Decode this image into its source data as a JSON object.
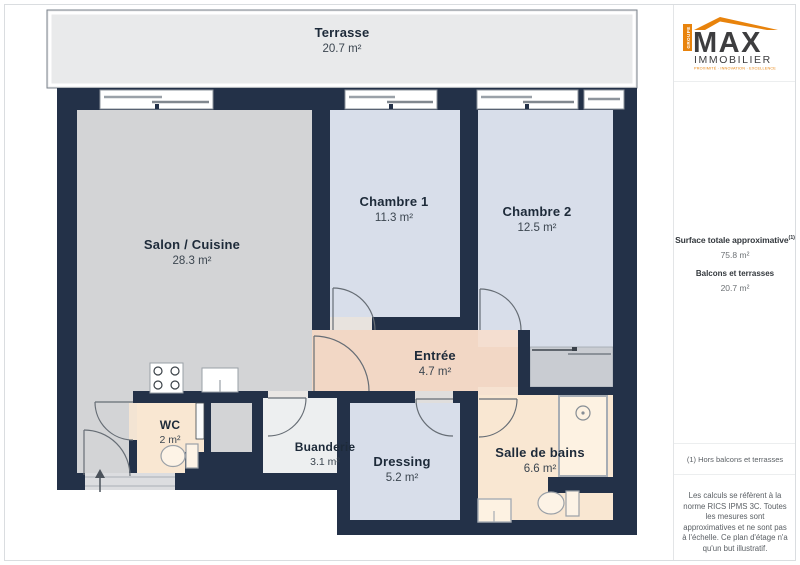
{
  "plan": {
    "rooms": [
      {
        "name": "Terrasse",
        "area": "20.7 m²"
      },
      {
        "name": "Salon / Cuisine",
        "area": "28.3 m²"
      },
      {
        "name": "Chambre 1",
        "area": "11.3 m²"
      },
      {
        "name": "Chambre 2",
        "area": "12.5 m²"
      },
      {
        "name": "Entrée",
        "area": "4.7 m²"
      },
      {
        "name": "WC",
        "area": "2 m²"
      },
      {
        "name": "Buanderie",
        "area": "3.1 m²"
      },
      {
        "name": "Dressing",
        "area": "5.2 m²"
      },
      {
        "name": "Salle de bains",
        "area": "6.6 m²"
      }
    ],
    "colors": {
      "wall": "#233148",
      "terrace": "#e9eaeb",
      "living": "#d3d4d6",
      "bedroom": "#d8deea",
      "hall": "#f2d7c5",
      "bathroom": "#f9e7d2",
      "laundry": "#edeff0",
      "accent_orange": "#e8830c"
    }
  },
  "sidebar": {
    "logo": {
      "group": "GROUPE",
      "name": "MAX",
      "sub": "IMMOBILIER",
      "tagline": "PROXIMITÉ · INNOVATION · EXCELLENCE"
    },
    "surface_title": "Surface totale approximative",
    "surface_sup": "(1)",
    "surface_value": "75.8 m²",
    "balcony_title": "Balcons et terrasses",
    "balcony_value": "20.7 m²",
    "footnote": "(1) Hors balcons et terrasses",
    "disclaimer": "Les calculs se réfèrent à la norme RICS IPMS 3C. Toutes les mesures sont approximatives et ne sont pas à l'échelle. Ce plan d'étage n'a qu'un but illustratif.",
    "brand": "GIRAFFE",
    "brand_suffix": "360"
  }
}
